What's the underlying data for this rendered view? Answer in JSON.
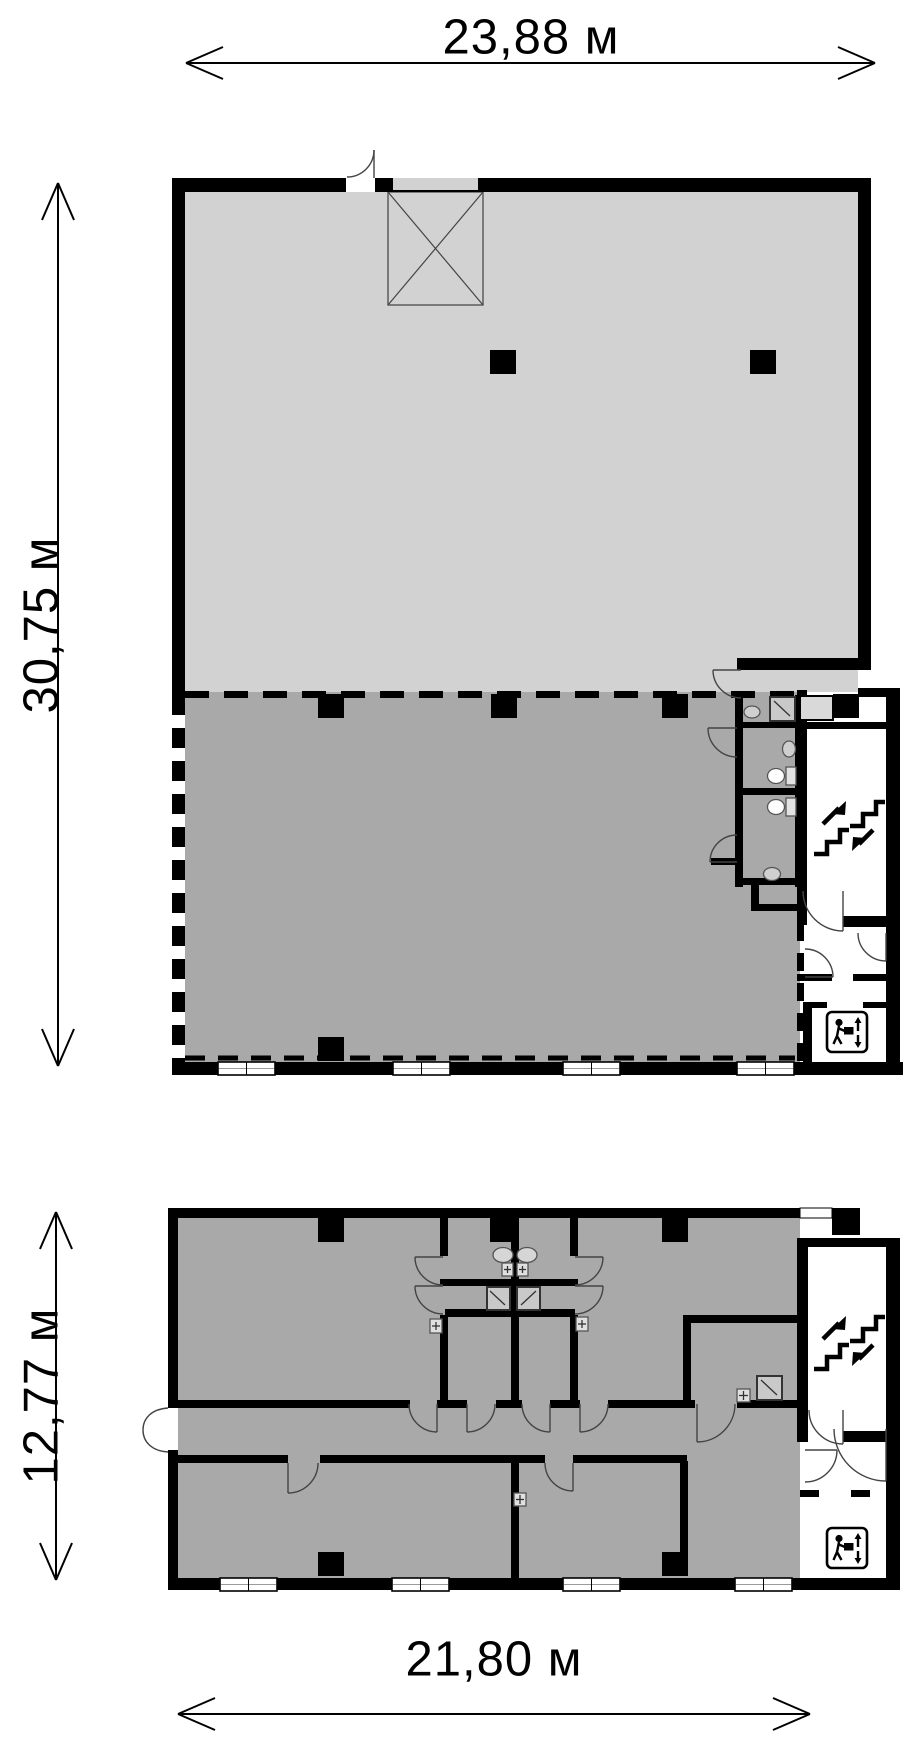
{
  "plan": {
    "kind": "floor-plan",
    "floors_shown": 2
  },
  "colors": {
    "background": "#ffffff",
    "wall": "#000000",
    "floor_zone_light": "#d2d2d2",
    "floor_zone_dark": "#a9a9a9",
    "lift_cabin": "#d9d9d9"
  },
  "dimensions": {
    "plan1_width": {
      "label": "23,88 м"
    },
    "plan1_height": {
      "label": "30,75 м"
    },
    "plan2_height": {
      "label": "12,77 м"
    },
    "plan2_width": {
      "label": "21,80 м"
    }
  },
  "icons": {
    "stairs": "stairs-up-down-icon",
    "freight_lift": "freight-elevator-icon"
  }
}
